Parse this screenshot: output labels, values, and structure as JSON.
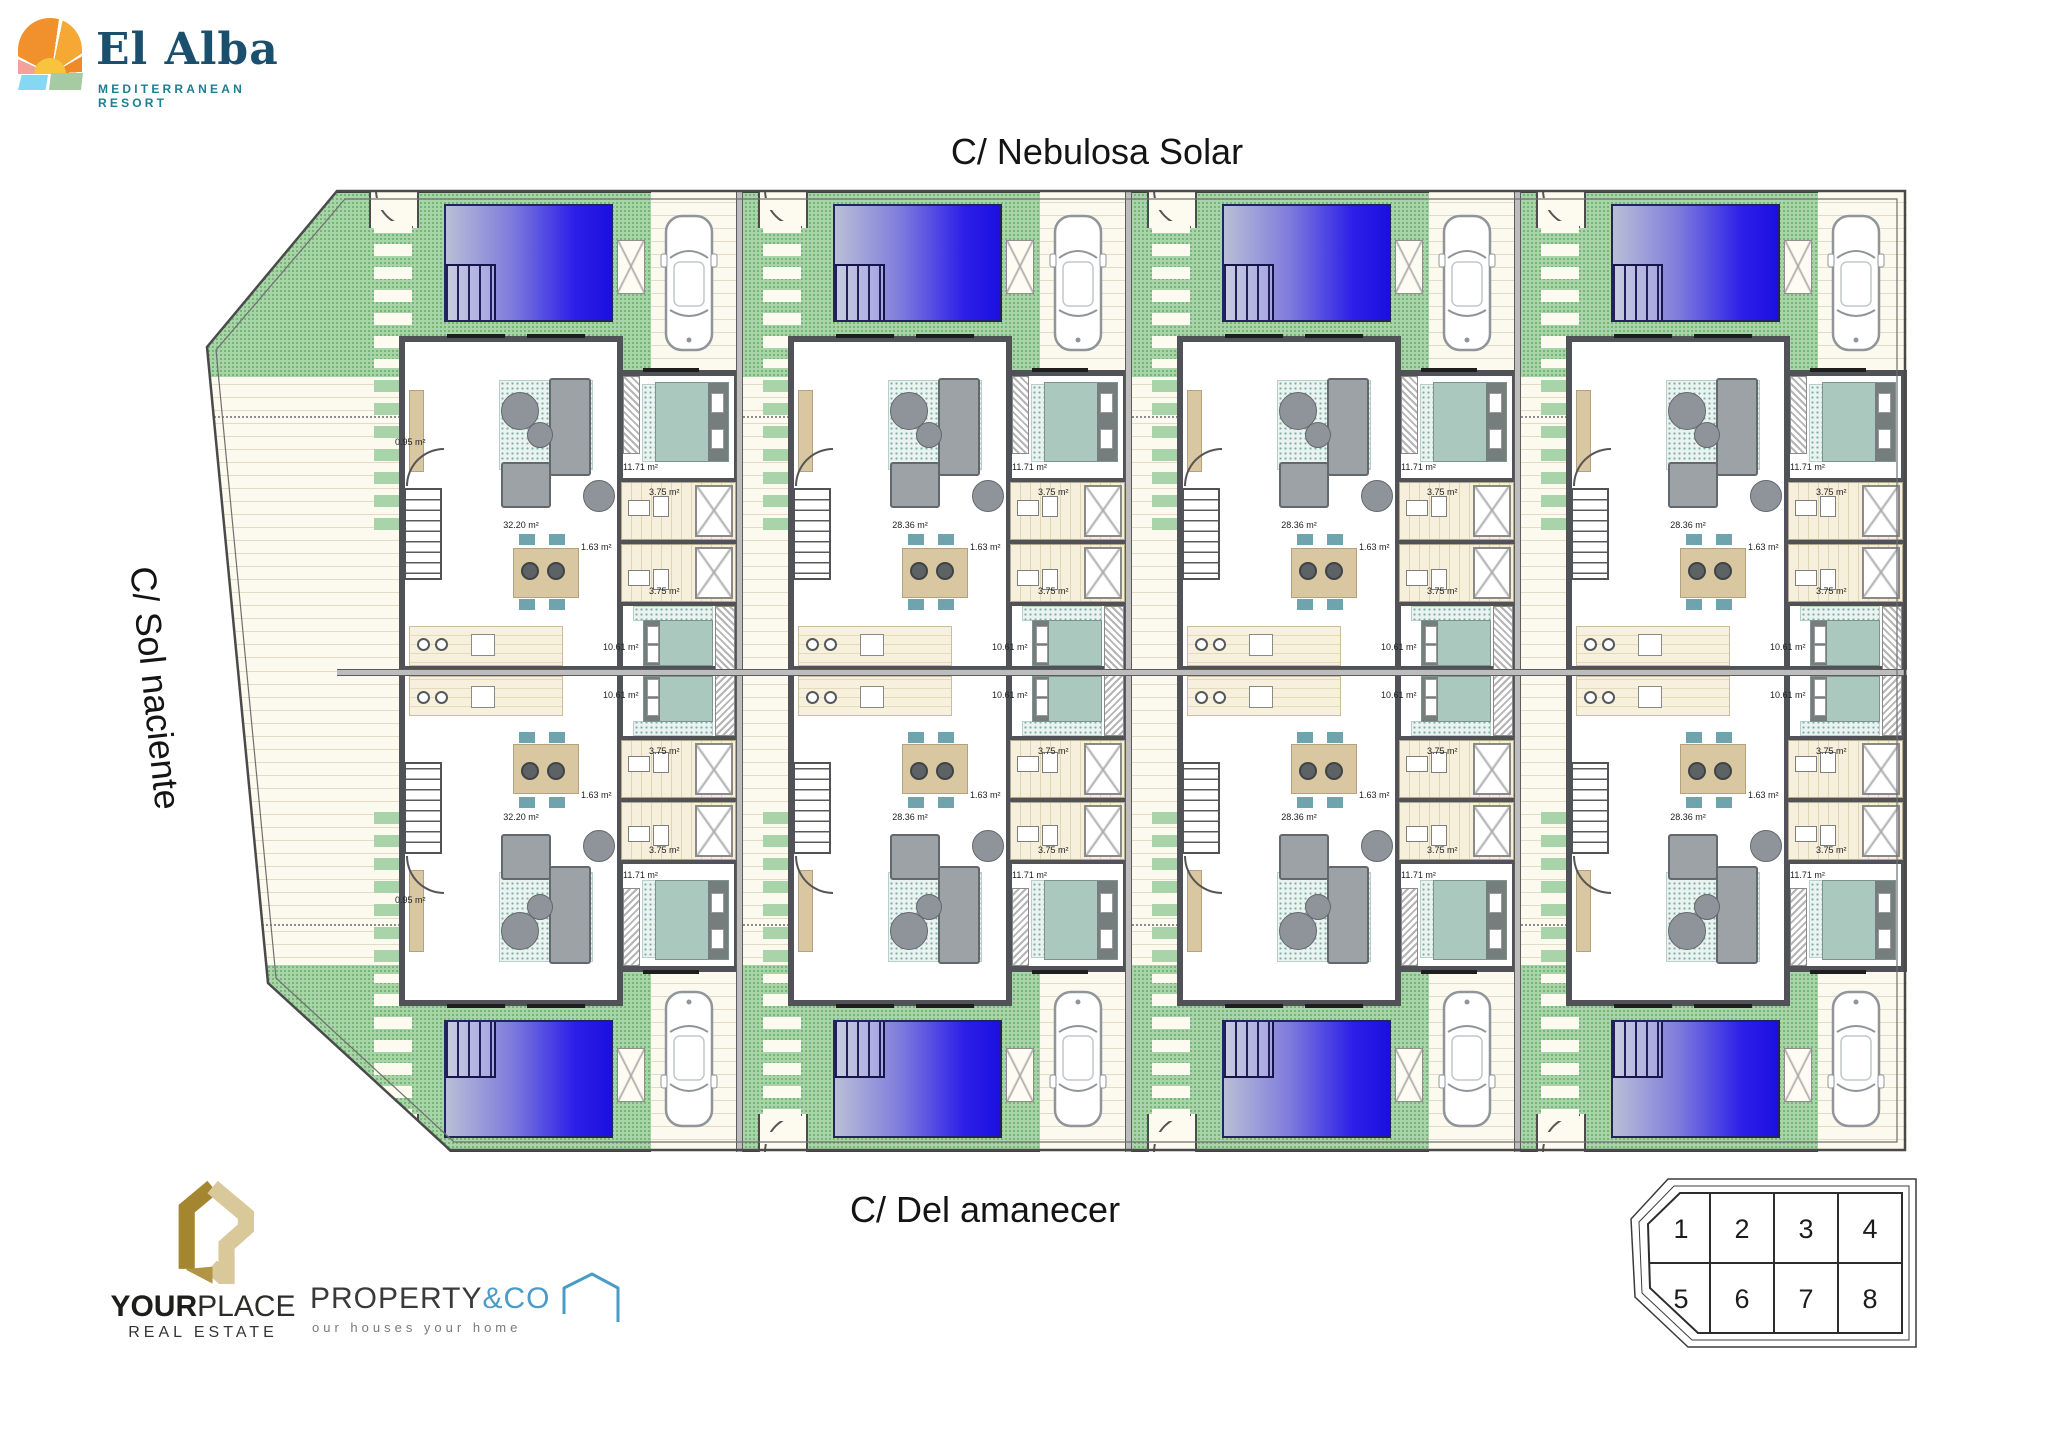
{
  "brand": {
    "name": "El Alba",
    "subtitle": "MEDITERRANEAN RESORT"
  },
  "streets": {
    "top": "C/ Nebulosa Solar",
    "left": "C/ Sol naciente",
    "bottom": "C/ Del amanecer"
  },
  "partners": {
    "yourplace": {
      "name_bold": "YOUR",
      "name_light": "PLACE",
      "subtitle": "REAL ESTATE"
    },
    "propertyco": {
      "name_dark": "PROPERTY",
      "name_accent": "&CO",
      "tagline": "our houses your home"
    }
  },
  "site_key": {
    "rows": [
      [
        "1",
        "2",
        "3",
        "4"
      ],
      [
        "5",
        "6",
        "7",
        "8"
      ]
    ]
  },
  "plots": [
    {
      "number": "1",
      "row": "top",
      "col": 1,
      "labels": {
        "living": "32.20 m²",
        "entry": "0.95 m²",
        "bedroom_main": "11.71 m²",
        "bath_a": "3.75 m²",
        "bath_b": "3.75 m²",
        "hall": "1.63 m²",
        "bedroom_second": "10.61 m²"
      }
    },
    {
      "number": "2",
      "row": "top",
      "col": 2,
      "labels": {
        "living": "28.36 m²",
        "bedroom_main": "11.71 m²",
        "bath_a": "3.75 m²",
        "bath_b": "3.75 m²",
        "hall": "1.63 m²",
        "bedroom_second": "10.61 m²"
      }
    },
    {
      "number": "3",
      "row": "top",
      "col": 3,
      "labels": {
        "living": "28.36 m²",
        "bedroom_main": "11.71 m²",
        "bath_a": "3.75 m²",
        "bath_b": "3.75 m²",
        "hall": "1.63 m²",
        "bedroom_second": "10.61 m²"
      }
    },
    {
      "number": "4",
      "row": "top",
      "col": 4,
      "labels": {
        "living": "28.36 m²",
        "bedroom_main": "11.71 m²",
        "bath_a": "3.75 m²",
        "bath_b": "3.75 m²",
        "hall": "1.63 m²",
        "bedroom_second": "10.61 m²"
      }
    },
    {
      "number": "5",
      "row": "bottom",
      "col": 1,
      "labels": {
        "living": "32.20 m²",
        "entry": "0.95 m²",
        "bedroom_main": "11.71 m²",
        "bath_a": "3.75 m²",
        "bath_b": "3.75 m²",
        "hall": "1.63 m²",
        "bedroom_second": "10.61 m²"
      }
    },
    {
      "number": "6",
      "row": "bottom",
      "col": 2,
      "labels": {
        "living": "28.36 m²",
        "bedroom_main": "11.71 m²",
        "bath_a": "3.75 m²",
        "bath_b": "3.75 m²",
        "hall": "1.63 m²",
        "bedroom_second": "10.61 m²"
      }
    },
    {
      "number": "7",
      "row": "bottom",
      "col": 3,
      "labels": {
        "living": "28.36 m²",
        "bedroom_main": "11.71 m²",
        "bath_a": "3.75 m²",
        "bath_b": "3.75 m²",
        "hall": "1.63 m²",
        "bedroom_second": "10.61 m²"
      }
    },
    {
      "number": "8",
      "row": "bottom",
      "col": 4,
      "labels": {
        "living": "28.36 m²",
        "bedroom_main": "11.71 m²",
        "bath_a": "3.75 m²",
        "bath_b": "3.75 m²",
        "hall": "1.63 m²",
        "bedroom_second": "10.61 m²"
      }
    }
  ],
  "colors": {
    "pool_blue": "#2012ea",
    "pool_light": "#b9bfd6",
    "garden_green": "#a9d4a9",
    "terrace_cream": "#fcfaee",
    "wall_gray": "#515257",
    "brand_navy": "#1a4f6e",
    "brand_teal": "#1b7f92",
    "gold": "#b9995a",
    "accent_blue": "#4a9bc8",
    "teal_furniture": "#abc8bf"
  }
}
